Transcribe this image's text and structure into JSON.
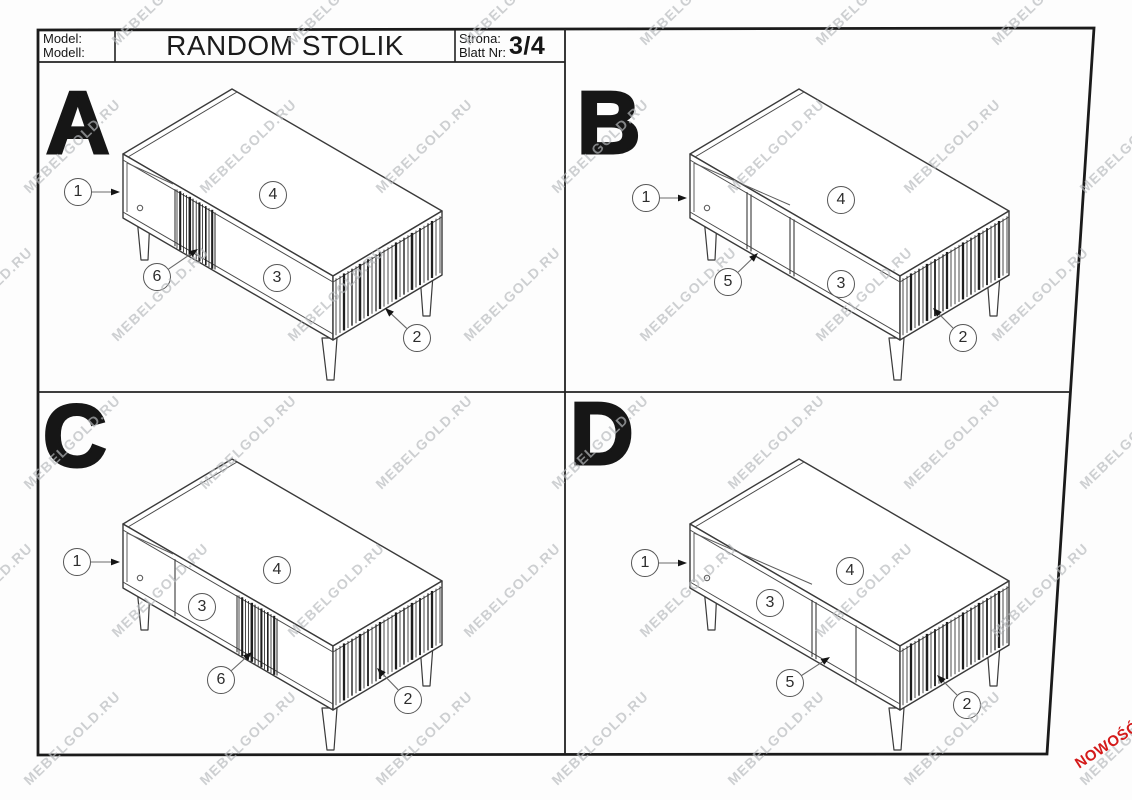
{
  "header": {
    "model_label_line1": "Model:",
    "model_label_line2": "Modell:",
    "title": "RANDOM STOLIK",
    "page_label_line1": "Strona:",
    "page_label_line2": "Blatt Nr:",
    "page_value": "3/4"
  },
  "watermark": {
    "text": "MEBELGOLD.RU",
    "color": "#b7babd"
  },
  "badge": {
    "text": "NOWOŚĆ",
    "color": "#d41a1a"
  },
  "line_color": "#3a3a3a",
  "quadrants": [
    {
      "letter": "A",
      "variant": "sliding-door-left",
      "letter_pos": {
        "x": 46,
        "y": 79
      },
      "table_origin": {
        "x": 123,
        "y": 154
      },
      "callouts": [
        {
          "label": "1",
          "cx": 78,
          "cy": 192,
          "tip": {
            "x": 120,
            "y": 192
          }
        },
        {
          "label": "4",
          "cx": 273,
          "cy": 195
        },
        {
          "label": "6",
          "cx": 157,
          "cy": 277,
          "tip": {
            "x": 198,
            "y": 249
          }
        },
        {
          "label": "3",
          "cx": 277,
          "cy": 278
        },
        {
          "label": "2",
          "cx": 417,
          "cy": 338,
          "tip": {
            "x": 385,
            "y": 308
          }
        }
      ]
    },
    {
      "letter": "B",
      "variant": "open-shelf-divider-left",
      "letter_pos": {
        "x": 577,
        "y": 79
      },
      "table_origin": {
        "x": 690,
        "y": 154
      },
      "callouts": [
        {
          "label": "1",
          "cx": 646,
          "cy": 198,
          "tip": {
            "x": 687,
            "y": 198
          }
        },
        {
          "label": "4",
          "cx": 841,
          "cy": 200
        },
        {
          "label": "5",
          "cx": 728,
          "cy": 282,
          "tip": {
            "x": 758,
            "y": 253
          }
        },
        {
          "label": "3",
          "cx": 841,
          "cy": 284
        },
        {
          "label": "2",
          "cx": 963,
          "cy": 338,
          "tip": {
            "x": 933,
            "y": 308
          }
        }
      ]
    },
    {
      "letter": "C",
      "variant": "sliding-door-center",
      "letter_pos": {
        "x": 43,
        "y": 392
      },
      "table_origin": {
        "x": 123,
        "y": 524
      },
      "callouts": [
        {
          "label": "1",
          "cx": 77,
          "cy": 562,
          "tip": {
            "x": 120,
            "y": 562
          }
        },
        {
          "label": "4",
          "cx": 277,
          "cy": 570
        },
        {
          "label": "3",
          "cx": 202,
          "cy": 607
        },
        {
          "label": "6",
          "cx": 221,
          "cy": 680,
          "tip": {
            "x": 252,
            "y": 652
          }
        },
        {
          "label": "2",
          "cx": 408,
          "cy": 700,
          "tip": {
            "x": 377,
            "y": 668
          }
        }
      ]
    },
    {
      "letter": "D",
      "variant": "open-shelf-divider-right",
      "letter_pos": {
        "x": 570,
        "y": 390
      },
      "table_origin": {
        "x": 690,
        "y": 524
      },
      "callouts": [
        {
          "label": "1",
          "cx": 645,
          "cy": 563,
          "tip": {
            "x": 687,
            "y": 563
          }
        },
        {
          "label": "4",
          "cx": 850,
          "cy": 571
        },
        {
          "label": "3",
          "cx": 770,
          "cy": 603
        },
        {
          "label": "5",
          "cx": 790,
          "cy": 683,
          "tip": {
            "x": 830,
            "y": 657
          }
        },
        {
          "label": "2",
          "cx": 967,
          "cy": 705,
          "tip": {
            "x": 937,
            "y": 675
          }
        }
      ]
    }
  ]
}
